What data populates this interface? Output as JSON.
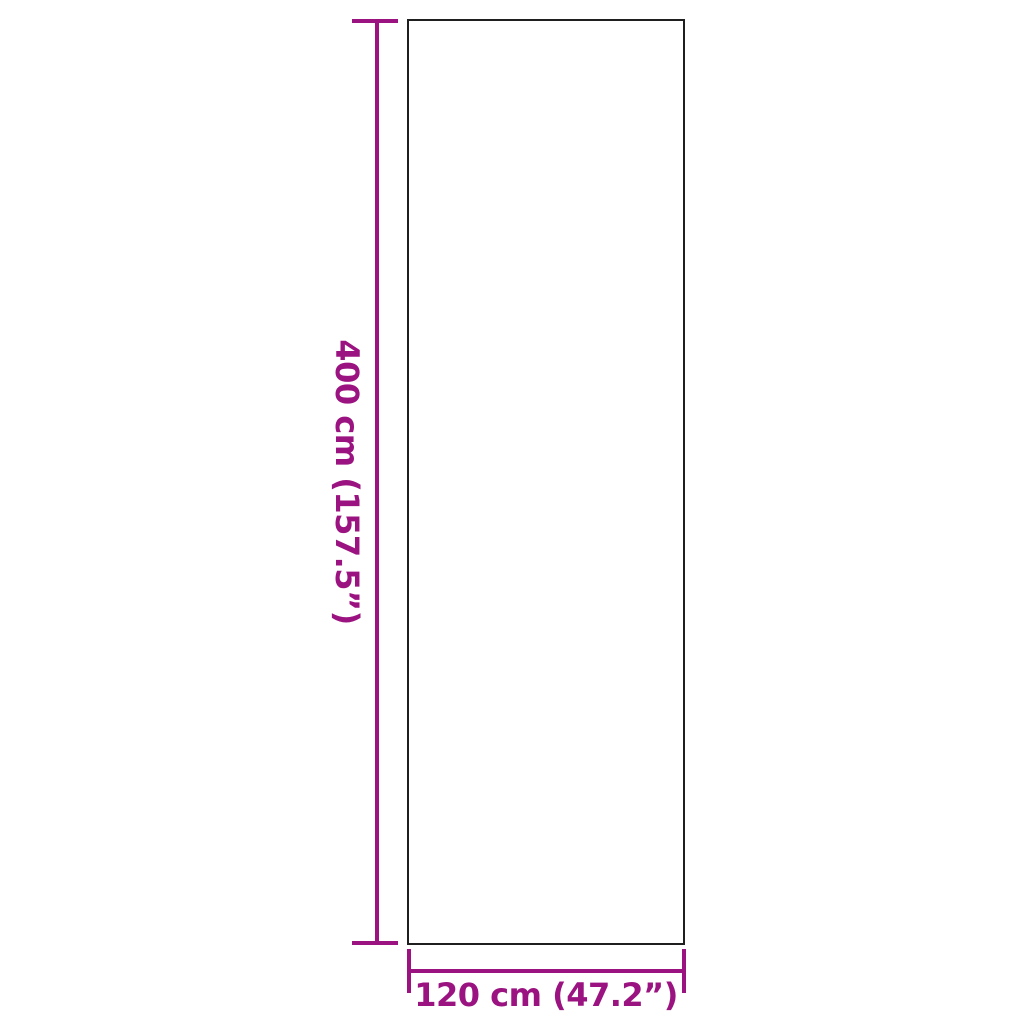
{
  "diagram": {
    "type": "product-dimension-diagram",
    "labels": {
      "height": "400 cm (157.5”)",
      "width": "120 cm (47.2”)"
    },
    "dimensions": {
      "height_cm": 400,
      "height_in": 157.5,
      "width_cm": 120,
      "width_in": 47.2
    }
  },
  "colors": {
    "accent": "#9b1380",
    "outline": "#1f1f1f",
    "background": "#ffffff"
  }
}
